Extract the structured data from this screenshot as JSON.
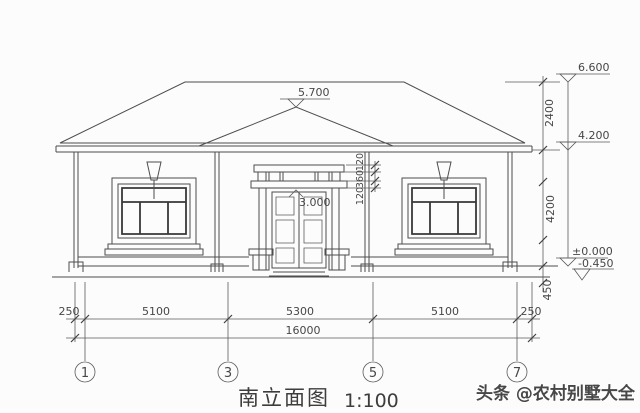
{
  "meta": {
    "background_color": "#fcfcfc",
    "line_color": "#4d4d4d",
    "watermark_color": "#cf3a2f"
  },
  "title": {
    "name": "南立面图",
    "scale": "1:100"
  },
  "watermark": {
    "text": "头条 @农村别墅大全"
  },
  "levels": {
    "ridge": "6.600",
    "porch_peak": "5.700",
    "eaves": "4.200",
    "door_head": "3.000",
    "floor": "±0.000",
    "ground": "-0.450"
  },
  "dims": {
    "vertical": {
      "roof_height": "2400",
      "storey_height": "4200",
      "plinth_height": "450"
    },
    "canopy_chain": [
      "120",
      "360",
      "120"
    ],
    "horizontal": {
      "left_overhang": "250",
      "bay_1_3": "5100",
      "bay_3_5": "5300",
      "bay_5_7": "5100",
      "right_overhang": "250",
      "total": "16000"
    }
  },
  "grid": {
    "bubbles": [
      "1",
      "3",
      "5",
      "7"
    ]
  }
}
